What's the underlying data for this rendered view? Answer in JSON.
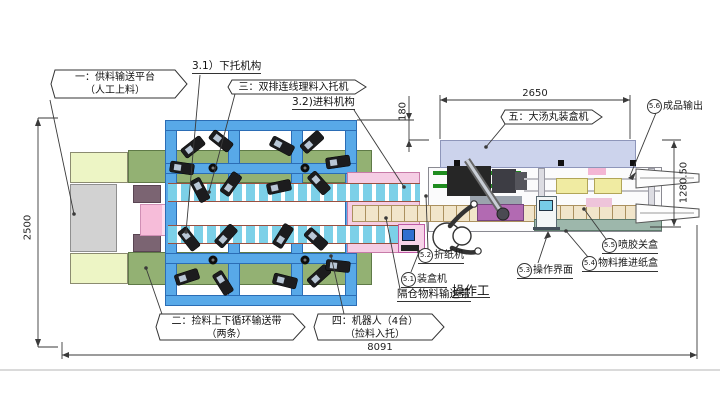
{
  "drawing": {
    "callouts": {
      "feed_platform": {
        "line1": "一：供料输送平台",
        "line2": "（人工上料）"
      },
      "circulation_belt": {
        "line1": "二：捡料上下循环输送带",
        "line2": "（两条）"
      },
      "tray_loader": {
        "label": "三：双排连线理料入托机"
      },
      "robots": {
        "line1": "四：机器人（4台）",
        "line2": "（捡料入托）"
      },
      "cartoner": {
        "label": "五：大汤丸装盒机"
      }
    },
    "sub_labels": {
      "lower_support": "3.1）下托机构",
      "infeed": "3.2)进料机构",
      "operator": "操作工",
      "compartment_belt": "隔仓物料输送带"
    },
    "numbered_labels": {
      "n51": {
        "num": "5.1",
        "text": "装盒机"
      },
      "n52": {
        "num": "5.2",
        "text": "折纸机"
      },
      "n53": {
        "num": "5.3",
        "text": "操作界面"
      },
      "n54": {
        "num": "5.4",
        "text": "物料推进纸盒"
      },
      "n55": {
        "num": "5.5",
        "text": "喷胶关盒"
      },
      "n56": {
        "num": "5.6",
        "text": "成品输出"
      }
    },
    "dimensions": {
      "total_length": "8091",
      "total_depth": "2500",
      "cartoner_length": "2650",
      "cartoner_depth": "1280.50",
      "offset": "180"
    },
    "colors": {
      "frame_blue": "#58a9e8",
      "conveyor_cyan": "#7cd0e8",
      "belt_green": "#93b173",
      "platform_gray": "#d2d2d2",
      "cartoner_lavender": "#ccd3ec",
      "feed_pink": "#f5cde4",
      "belt_beige": "#f1e5ca"
    }
  }
}
